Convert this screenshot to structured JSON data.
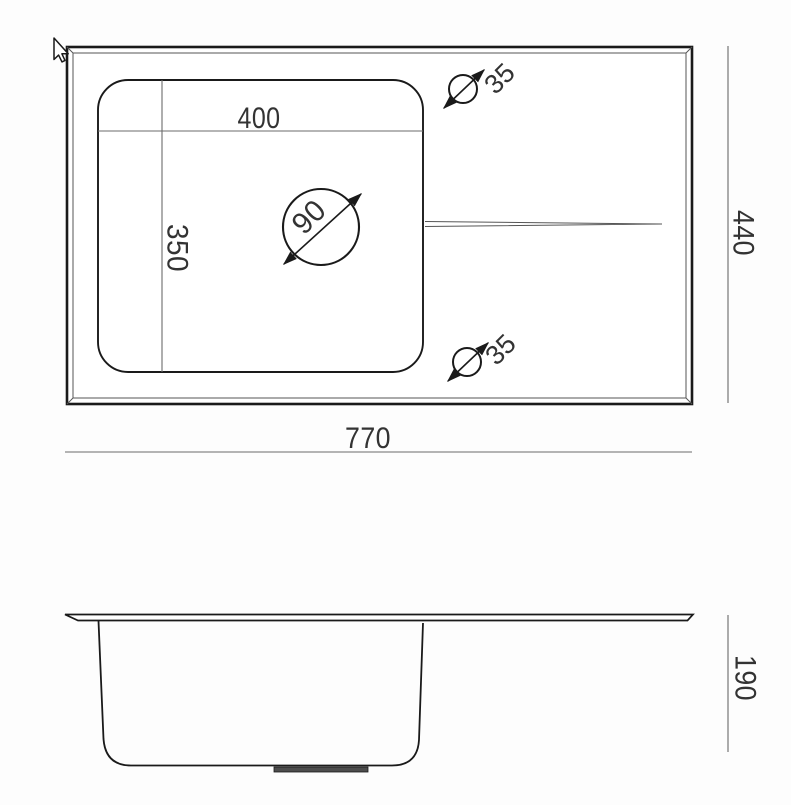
{
  "colors": {
    "background": "#fdfdfd",
    "outline": "#1a1a1a",
    "dimension_line": "#6b6b6b",
    "label_text": "#333333",
    "drain_fitting_fill": "#4d4d4d"
  },
  "icons": {
    "cursor": "arrow-cursor-icon"
  },
  "top_view": {
    "overall_width": "770",
    "overall_height": "440",
    "bowl_width": "400",
    "bowl_height": "350",
    "drain_diameter": "90",
    "tap_hole_top_diameter": "35",
    "tap_hole_bottom_diameter": "35"
  },
  "side_view": {
    "depth": "190"
  }
}
